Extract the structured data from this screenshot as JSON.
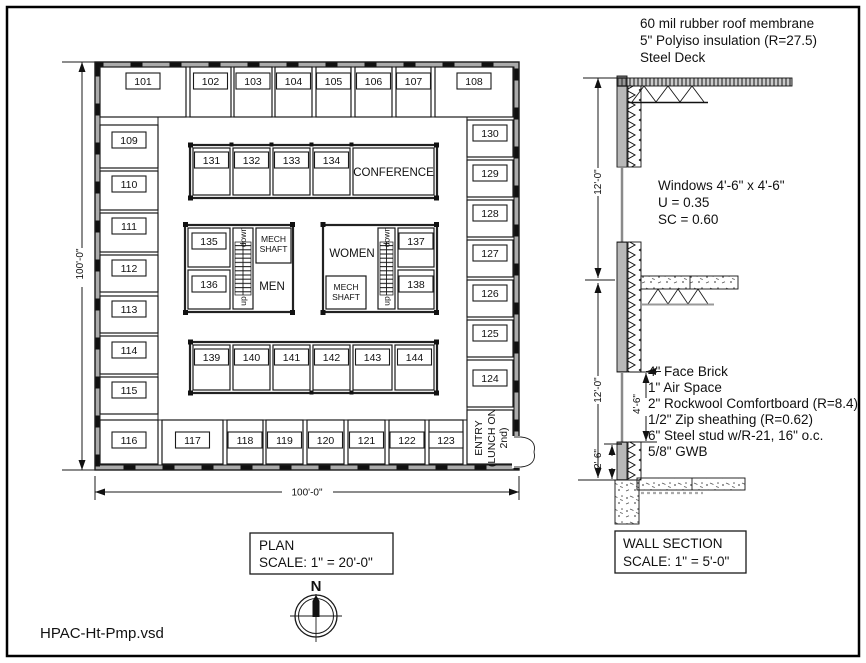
{
  "meta": {
    "filename": "HPAC-Ht-Pmp.vsd"
  },
  "plan": {
    "box_title": "PLAN",
    "box_scale": "SCALE:  1\" = 20'-0\"",
    "dim_vertical": "100'-0\"",
    "dim_horizontal": "100'-0\"",
    "north_label": "N",
    "entry_lines": [
      "ENTRY",
      "(LUNCH ON",
      "2nd)"
    ],
    "labels": {
      "conference": "CONFERENCE",
      "men": "MEN",
      "women": "WOMEN",
      "mech1": "MECH",
      "mech2": "SHAFT",
      "down": "down",
      "up": "up"
    },
    "rooms": {
      "top": [
        "101",
        "102",
        "103",
        "104",
        "105",
        "106",
        "107",
        "108"
      ],
      "left": [
        "109",
        "110",
        "111",
        "112",
        "113",
        "114",
        "115"
      ],
      "right": [
        "130",
        "129",
        "128",
        "127",
        "126",
        "125",
        "124"
      ],
      "bottom": [
        "116",
        "117",
        "118",
        "119",
        "120",
        "121",
        "122",
        "123"
      ],
      "inner_top": [
        "131",
        "132",
        "133",
        "134"
      ],
      "mid_left": [
        "135",
        "136"
      ],
      "mid_right": [
        "137",
        "138"
      ],
      "inner_bottom": [
        "139",
        "140",
        "141",
        "142",
        "143",
        "144"
      ]
    }
  },
  "section": {
    "box_title": "WALL SECTION",
    "box_scale": "SCALE:  1\" = 5'-0\"",
    "roof_notes": [
      "60 mil rubber roof membrane",
      "5\" Polyiso insulation (R=27.5)",
      "Steel Deck"
    ],
    "window_notes": [
      "Windows 4'-6\" x 4'-6\"",
      "U = 0.35",
      "SC = 0.60"
    ],
    "wall_notes": [
      "4\" Face Brick",
      "1\" Air Space",
      "2\" Rockwool Comfortboard (R=8.4)",
      "1/2\" Zip sheathing (R=0.62)",
      "6\" Steel stud w/R-21, 16\" o.c.",
      "5/8\" GWB"
    ],
    "dim_upper": "12'-0\"",
    "dim_lower": "12'-0\"",
    "dim_window": "4'-6\"",
    "dim_sill": "2'-6\""
  }
}
